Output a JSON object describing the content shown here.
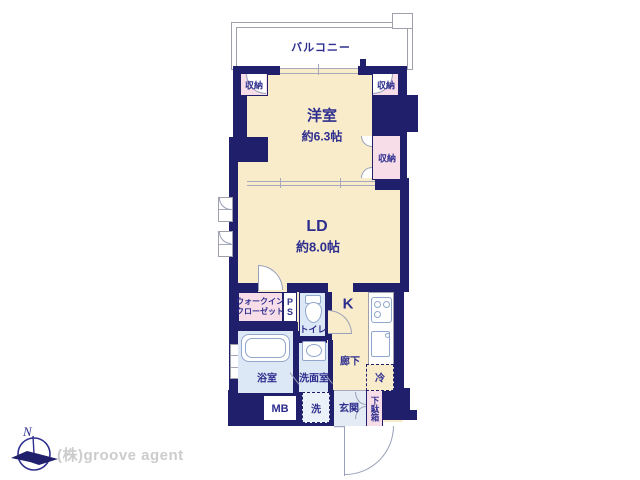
{
  "colors": {
    "wall": "#1f1f6b",
    "room_fill": "#f8ecca",
    "closet_fill": "#f7dde8",
    "wet_fill": "#dce8f5",
    "entrance_fill": "#e4ebf4",
    "laundry_fill": "#eaf1f8",
    "label_text": "#2e2e8f",
    "line_gray": "#9aa0b8",
    "company_text": "#cccccc"
  },
  "plan": {
    "balcony_label": "バルコニー",
    "western_room": {
      "name": "洋室",
      "size": "約6.3帖"
    },
    "living_dining": {
      "name": "LD",
      "size": "約8.0帖"
    },
    "closet_labels": [
      "収納",
      "収納",
      "収納"
    ],
    "walk_in_closet_lines": [
      "ウォークイン",
      "クローゼット"
    ],
    "pipe_space": "PS",
    "toilet": "トイレ",
    "kitchen": "K",
    "hallway": "廊下",
    "refrigerator": "冷",
    "bathroom": "浴室",
    "washroom": "洗面室",
    "meter_box": "MB",
    "laundry": "洗",
    "entrance": "玄関",
    "shoe_cabinet": "下駄箱"
  },
  "footer": {
    "compass_north": "N",
    "company": "(株)groove agent"
  }
}
